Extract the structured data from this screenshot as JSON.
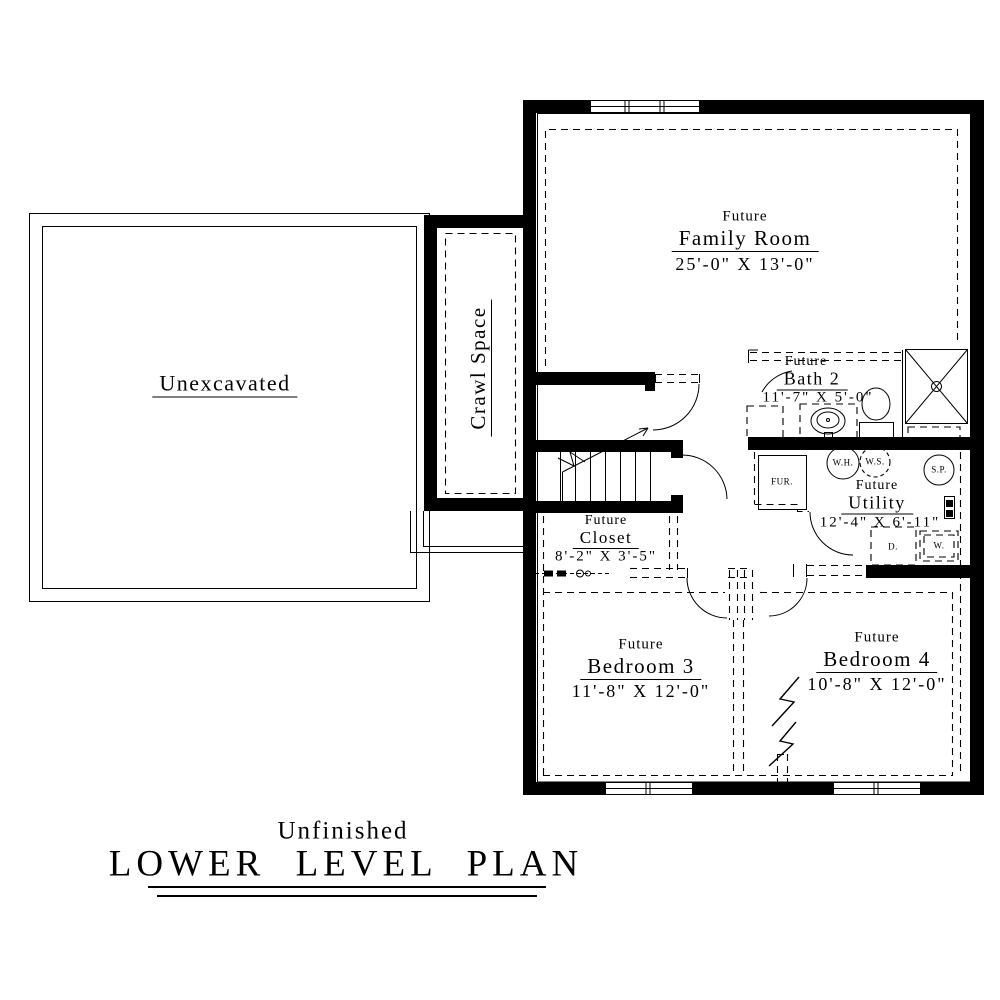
{
  "rooms": {
    "unexcavated": {
      "name": "Unexcavated"
    },
    "crawl_space": {
      "name": "Crawl Space"
    },
    "family_room": {
      "prefix": "Future",
      "name": "Family Room",
      "dims": "25'-0\" X 13'-0\""
    },
    "bath2": {
      "prefix": "Future",
      "name": "Bath 2",
      "dims": "11'-7\" X 5'-0\""
    },
    "utility": {
      "prefix": "Future",
      "name": "Utility",
      "dims": "12'-4\" X 6'-11\""
    },
    "closet": {
      "prefix": "Future",
      "name": "Closet",
      "dims": "8'-2\" X 3'-5\""
    },
    "bedroom3": {
      "prefix": "Future",
      "name": "Bedroom 3",
      "dims": "11'-8\" X 12'-0\""
    },
    "bedroom4": {
      "prefix": "Future",
      "name": "Bedroom 4",
      "dims": "10'-8\" X 12'-0\""
    }
  },
  "equipment": {
    "furnace": "FUR.",
    "water_heater": "W.H.",
    "water_softener": "W.S.",
    "sump_pump": "S.P.",
    "dryer": "D.",
    "washer": "W."
  },
  "title": {
    "subtitle": "Unfinished",
    "main": "LOWER LEVEL PLAN"
  },
  "colors": {
    "line": "#000000",
    "background": "#ffffff"
  }
}
